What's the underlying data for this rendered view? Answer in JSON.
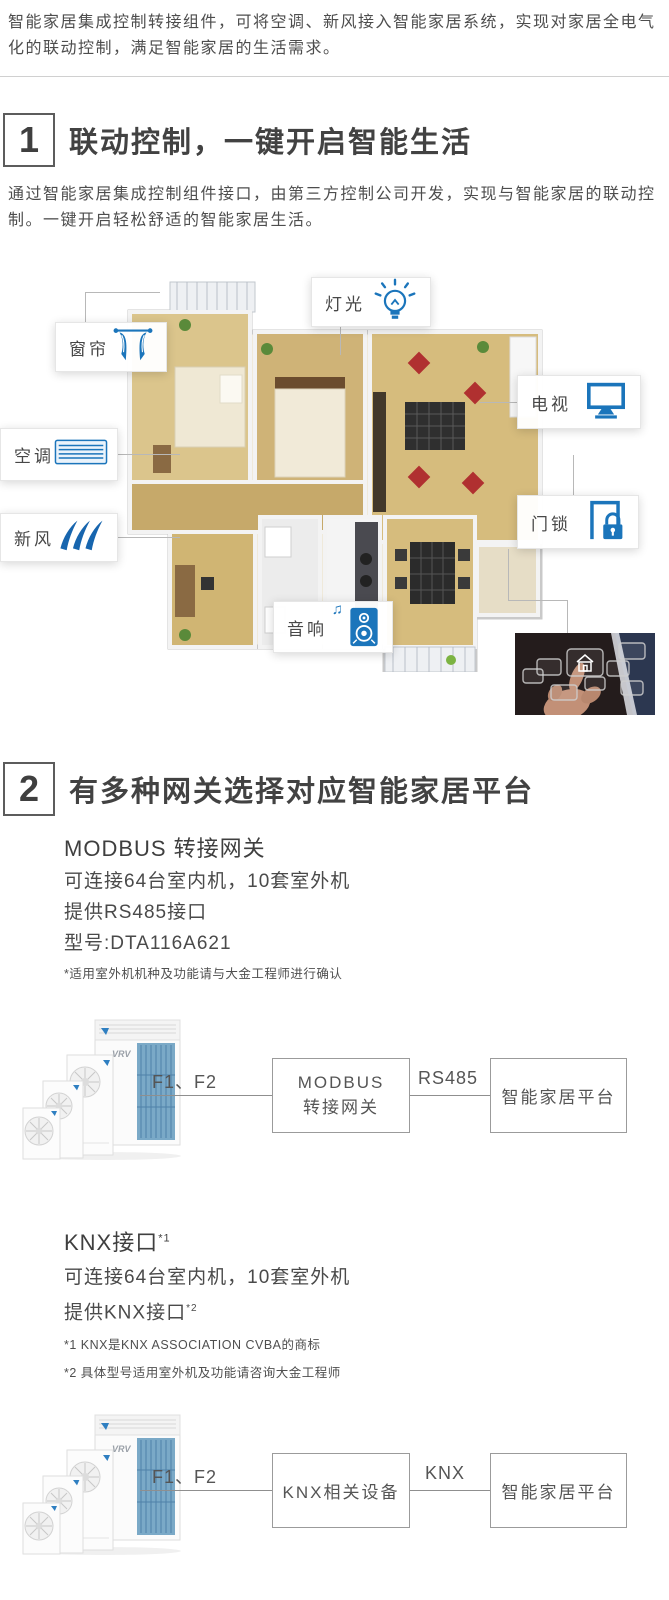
{
  "colors": {
    "icon_blue": "#1b75bb",
    "heading": "#424242",
    "body_text": "#4d4d4d"
  },
  "intro": {
    "text": "智能家居集成控制转接组件，可将空调、新风接入智能家居系统，实现对家居全电气化的联动控制，满足智能家居的生活需求。"
  },
  "section1": {
    "number": "1",
    "title": "联动控制，一键开启智能生活",
    "description": "通过智能家居集成控制组件接口，由第三方控制公司开发，实现与智能家居的联动控制。一键开启轻松舒适的智能家居生活。",
    "callouts": {
      "curtain": {
        "label": "窗帘",
        "icon": "curtain-icon"
      },
      "light": {
        "label": "灯光",
        "icon": "light-bulb-icon"
      },
      "tv": {
        "label": "电视",
        "icon": "tv-icon"
      },
      "ac": {
        "label": "空调",
        "icon": "ac-vent-icon"
      },
      "fresh_air": {
        "label": "新风",
        "icon": "wind-icon"
      },
      "door_lock": {
        "label": "门锁",
        "icon": "door-lock-icon"
      },
      "audio": {
        "label": "音响",
        "icon": "speaker-icon",
        "note_glyph": "♫"
      }
    }
  },
  "section2": {
    "number": "2",
    "title": "有多种网关选择对应智能家居平台",
    "unit_brand": "VRV",
    "modbus": {
      "subtitle": "MODBUS 转接网关",
      "specs": [
        "可连接64台室内机，10套室外机",
        "提供RS485接口",
        "型号:DTA116A621"
      ],
      "footnote": "*适用室外机机种及功能请与大金工程师进行确认",
      "diagram": {
        "wiring_label": "F1、F2",
        "gateway_line1": "MODBUS",
        "gateway_line2": "转接网关",
        "link_label": "RS485",
        "platform": "智能家居平台"
      }
    },
    "knx": {
      "subtitle": "KNX接口",
      "subtitle_note": "*1",
      "specs_line1": "可连接64台室内机，10套室外机",
      "specs_line2": "提供KNX接口",
      "specs_line2_note": "*2",
      "footnote1": "*1 KNX是KNX ASSOCIATION CVBA的商标",
      "footnote2": "*2 具体型号适用室外机及功能请咨询大金工程师",
      "diagram": {
        "wiring_label": "F1、F2",
        "device": "KNX相关设备",
        "link_label": "KNX",
        "platform": "智能家居平台"
      }
    }
  }
}
